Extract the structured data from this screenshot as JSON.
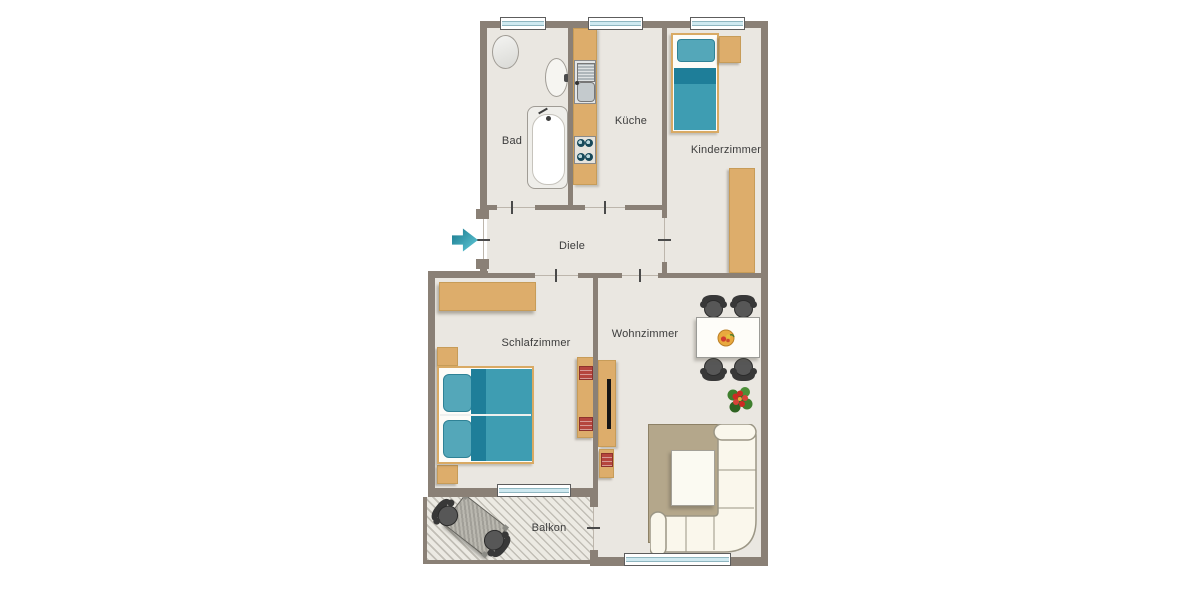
{
  "floorplan": {
    "rooms": {
      "bad": {
        "label": "Bad"
      },
      "kueche": {
        "label": "Küche"
      },
      "kinderzimmer": {
        "label": "Kinderzimmer"
      },
      "diele": {
        "label": "Diele"
      },
      "schlafzimmer": {
        "label": "Schlafzimmer"
      },
      "wohnzimmer": {
        "label": "Wohnzimmer"
      },
      "balkon": {
        "label": "Balkon"
      }
    },
    "entrance": {
      "symbol": "arrow-right",
      "color": "#2f97a9"
    },
    "colors": {
      "wall": "#8a8076",
      "floor": "#eae7e1",
      "wood": "#ddad6b",
      "window_glass": "#cfe9f0",
      "teal_dark": "#1e7e99",
      "teal": "#3e9db2",
      "teal_light": "#54a7b9",
      "rug": "#b4a78b",
      "sofa": "#faf7ec",
      "chair_dark": "#474747",
      "book_red": "#b5453e",
      "fruit_orange": "#e9a93e",
      "flower_red": "#cc2a22",
      "leaf_green": "#3f7f2e"
    }
  }
}
